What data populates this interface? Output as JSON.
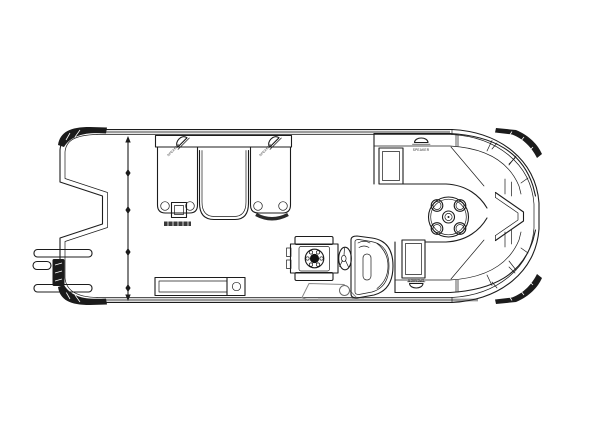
{
  "diagram": {
    "type": "pontoon boat floor plan (top view line drawing)",
    "labels": {
      "speaker": "SPEAKER"
    },
    "colors": {
      "line": "#1c1c1c",
      "rub_rail": "#9c9c9c",
      "corner_cap": "#1b1b1b",
      "background": "#ffffff"
    },
    "components": [
      "bow-boarding-ladder",
      "notched-bow-fence",
      "bow-gate-line",
      "port-bow-chaise-lounge",
      "starboard-bow-chaise-lounge",
      "subwoofer-box",
      "cup-holders",
      "helm-chair",
      "steering-wheel",
      "helm-console",
      "stern-wraparound-lounge-top",
      "stern-wraparound-lounge-bottom",
      "round-table-with-cupholders",
      "stern-entry-notch",
      "speakers"
    ]
  }
}
